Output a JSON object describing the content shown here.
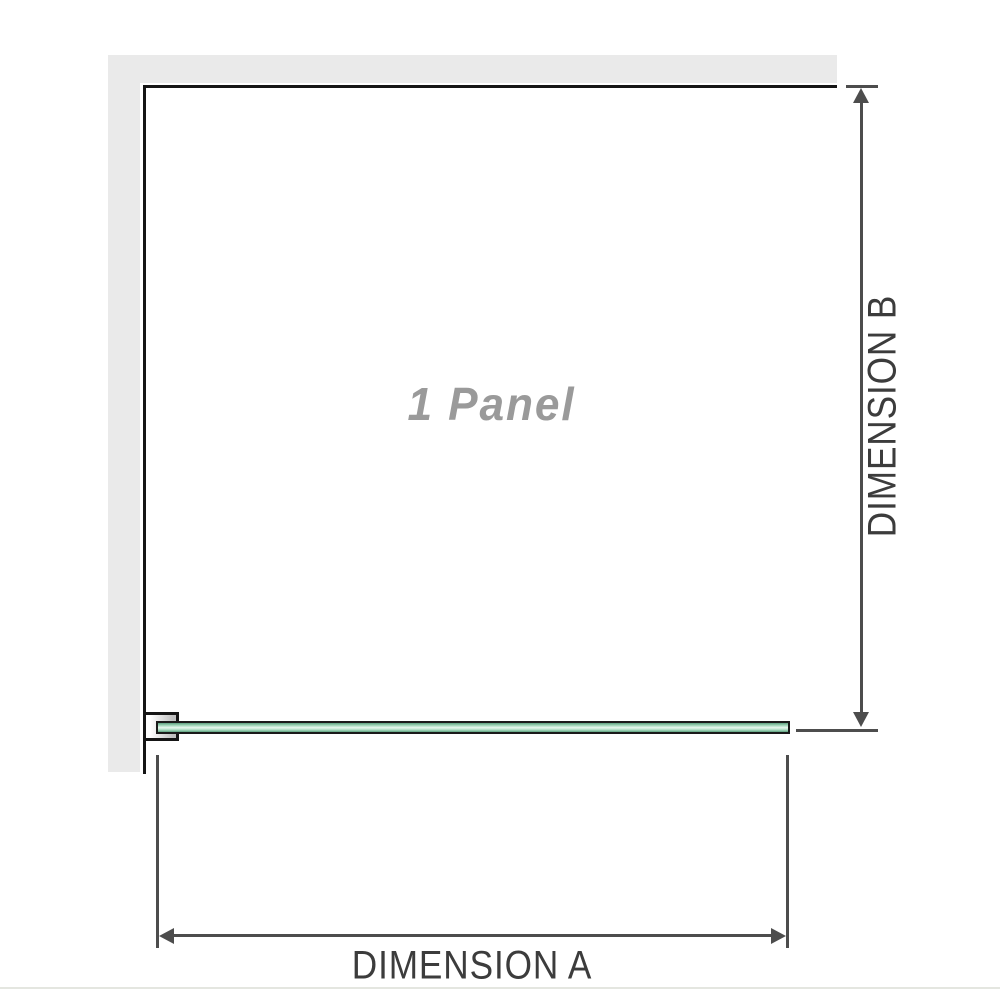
{
  "diagram": {
    "panel_label": "1 Panel",
    "dimension_a_label": "DIMENSION A",
    "dimension_b_label": "DIMENSION B"
  },
  "colors": {
    "wall": "#eaeaea",
    "outline": "#151515",
    "dimension": "#4d4d4d",
    "label_text": "#3c3c3c",
    "panel_text": "#9a9a9a",
    "glass_border": "#1a1a1a",
    "glass_green": "#a5dabd",
    "glass_dark": "#5d9f7e",
    "glass_light": "#e9f7ef",
    "bracket_shade": "#bfbfbf",
    "baseline": "#e4e6e0"
  }
}
